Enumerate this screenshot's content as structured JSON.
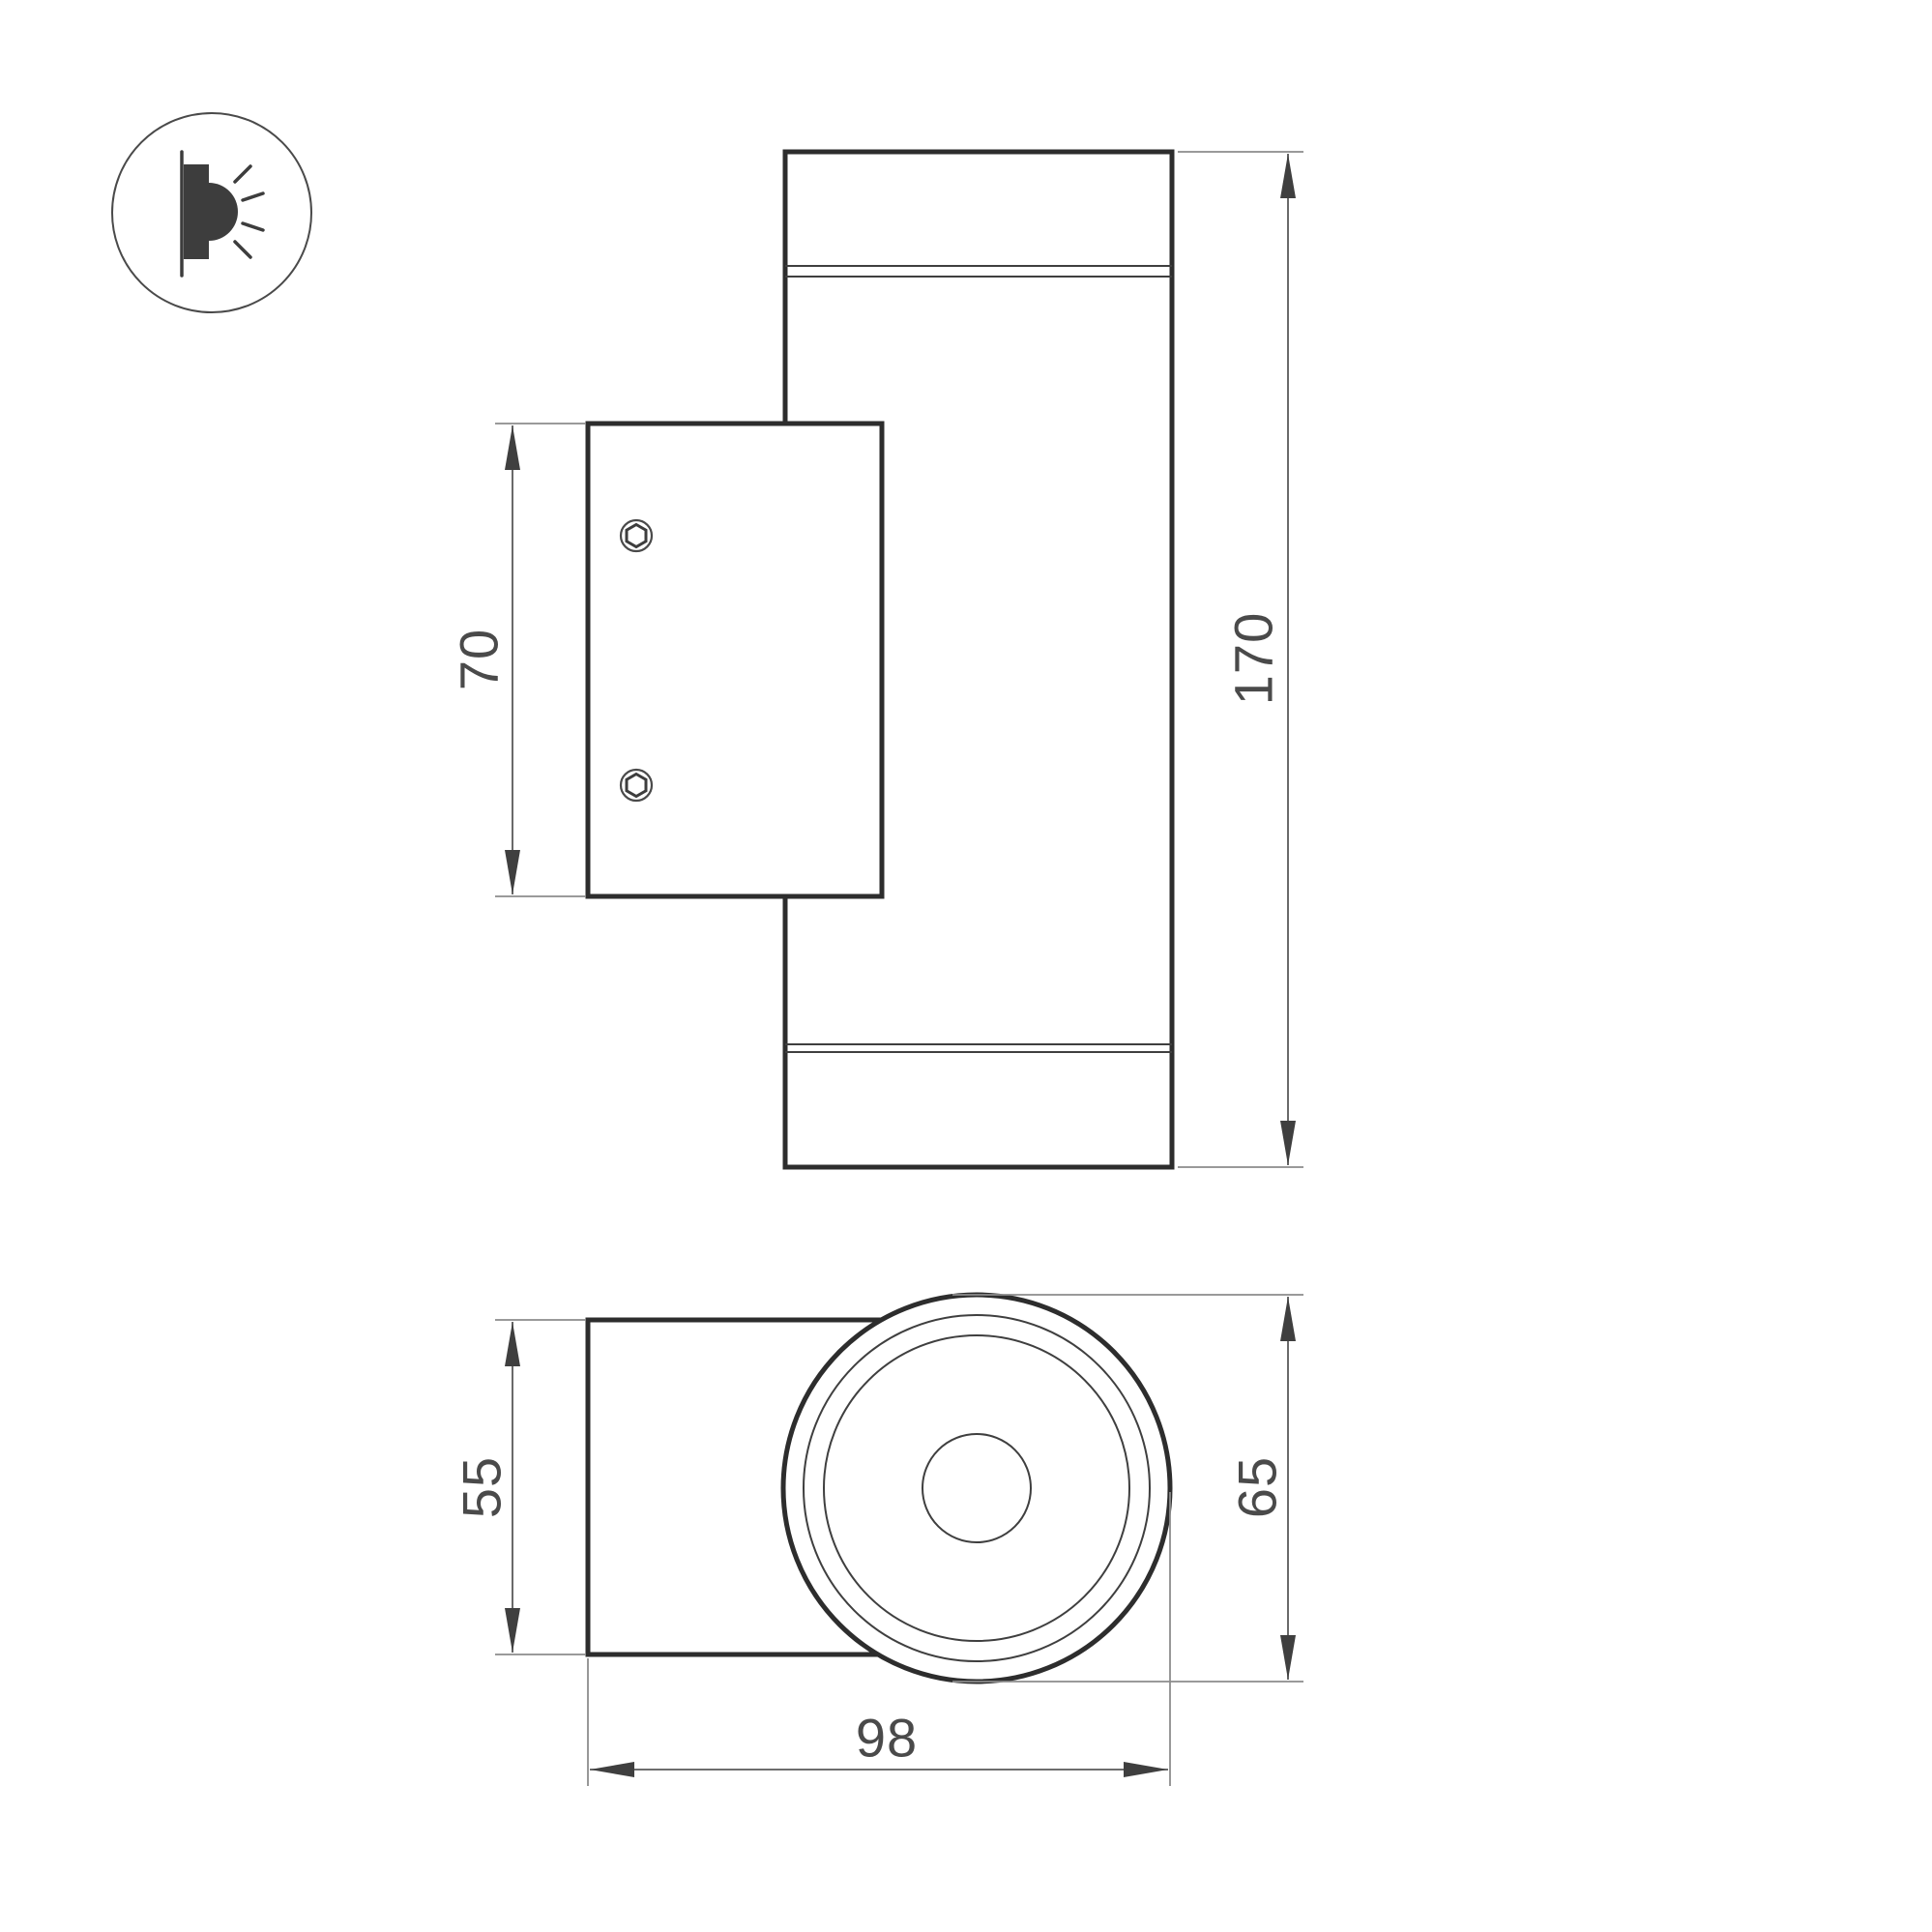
{
  "drawing": {
    "type": "technical-dimension-drawing",
    "subject": "wall-mounted cylindrical luminaire, two projection views",
    "icon": {
      "name": "wall-light-side-emission-icon",
      "description": "circle badge with wall-mounted lamp emitting light rays to one side"
    },
    "side_view": {
      "dim_plate_height": "70",
      "dim_total_height": "170"
    },
    "bottom_view": {
      "dim_body_depth": "55",
      "dim_face_diameter": "65",
      "dim_total_depth": "98"
    },
    "colors": {
      "background": "#ffffff",
      "outline": "#2d2d2d",
      "thin_line": "#3f3f3f",
      "extension_line": "#8c8c8c",
      "dimension_line": "#5a5a5a",
      "dimension_text": "#4a4a4a",
      "icon_fill": "#3d3d3d"
    }
  }
}
